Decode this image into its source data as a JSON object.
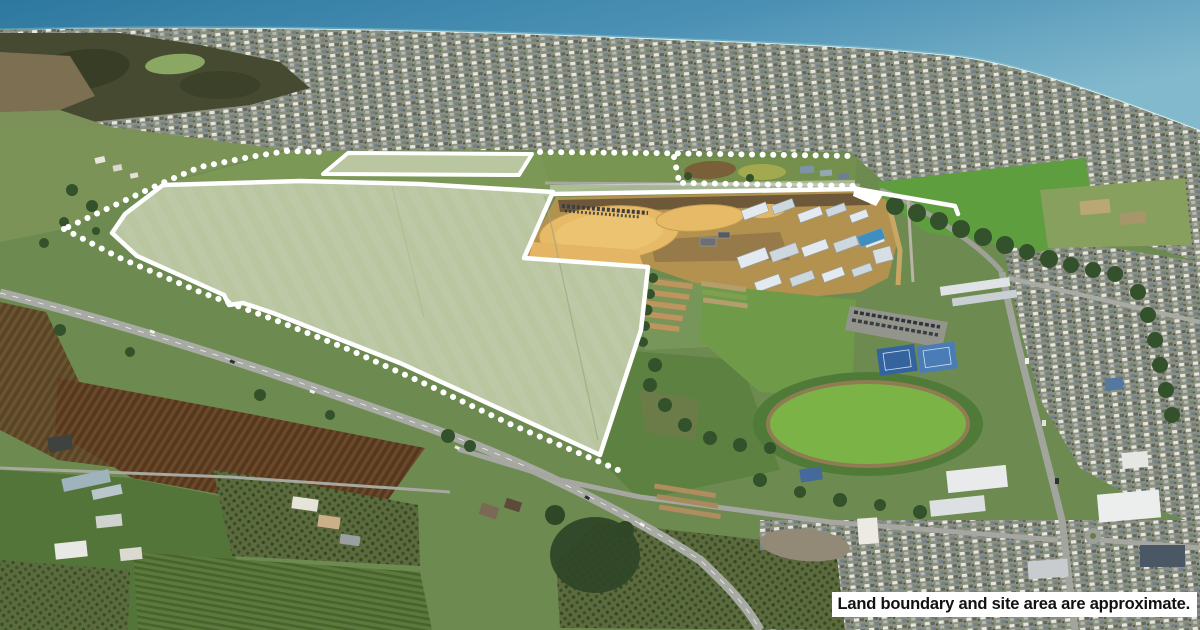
{
  "disclaimer": {
    "text": "Land boundary and site area are approximate."
  },
  "colors": {
    "boundary": "#ffffff",
    "parcel": "#b9c6a0",
    "ocean-deep": "#2d789f",
    "ocean-mid": "#4a90b4",
    "ocean-light": "#83b9cd",
    "shore-foam": "#e8f7f6",
    "land-base": "#6d8a50",
    "bright-field": "#5f9e3e",
    "construction-dirt": "#e6ba66",
    "construction-base": "#b3914f",
    "plough-brown": "#56381f",
    "road-grey": "#a8aaa4",
    "tree-dark": "#33522b",
    "oval-green": "#7cb347",
    "tennis-blue": "#35639e",
    "label-bg": "#ffffff",
    "label-text": "#111111"
  }
}
